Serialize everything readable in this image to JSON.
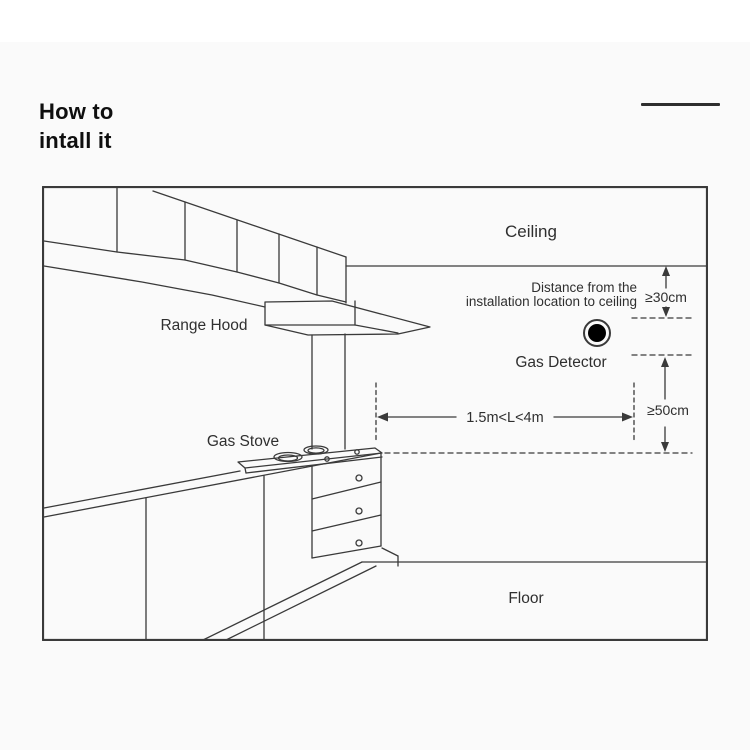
{
  "title": {
    "line1": "How to",
    "line2": "intall it"
  },
  "diagram": {
    "labels": {
      "ceiling": "Ceiling",
      "floor": "Floor",
      "range_hood": "Range Hood",
      "gas_stove": "Gas Stove",
      "gas_detector": "Gas Detector",
      "distance_note_line1": "Distance from the",
      "distance_note_line2": "installation location to ceiling",
      "ceiling_clearance": "≥30cm",
      "floor_clearance": "≥50cm",
      "stove_distance": "1.5m<L<4m"
    },
    "colors": {
      "line": "#3a3a3a",
      "border": "#4a4a4a",
      "text": "#2f2f2f",
      "detector": "#000000"
    }
  }
}
